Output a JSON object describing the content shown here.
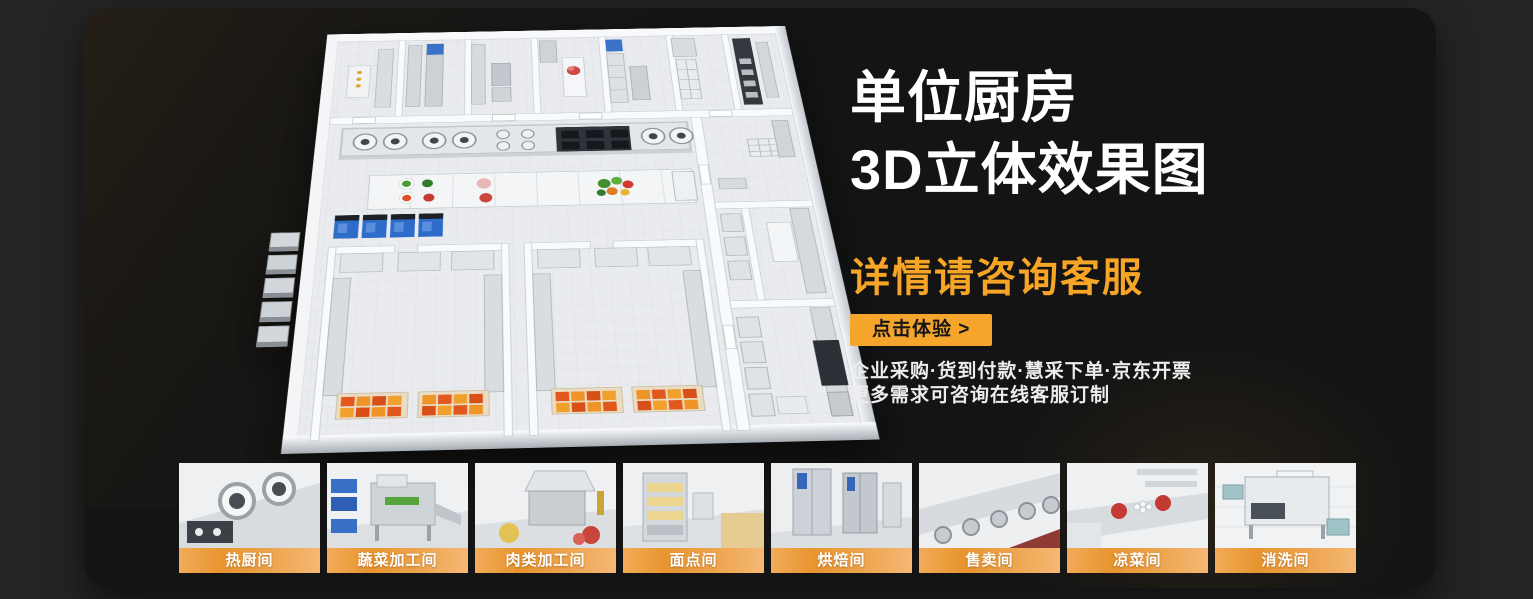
{
  "page": {
    "background": "#242424",
    "panel_background": "#141414"
  },
  "hero": {
    "title_line1": "单位厨房",
    "title_line2": "3D立体效果图",
    "subtitle": "详情请咨询客服",
    "cta_label": "点击体验 >",
    "info_line1": "企业采购·货到付款·慧采下单·京东开票",
    "info_line2": "更多需求可咨询在线客服订制",
    "accent_color": "#F6A527"
  },
  "floorplan": {
    "name": "unit-kitchen-3d-floorplan"
  },
  "label_bar": {
    "gradient_start": "#E8952F",
    "gradient_end": "#F5B874"
  },
  "thumbnails": [
    {
      "label": "热厨间"
    },
    {
      "label": "蔬菜加工间"
    },
    {
      "label": "肉类加工间"
    },
    {
      "label": "面点间"
    },
    {
      "label": "烘焙间"
    },
    {
      "label": "售卖间"
    },
    {
      "label": "凉菜间"
    },
    {
      "label": "消洗间"
    }
  ]
}
